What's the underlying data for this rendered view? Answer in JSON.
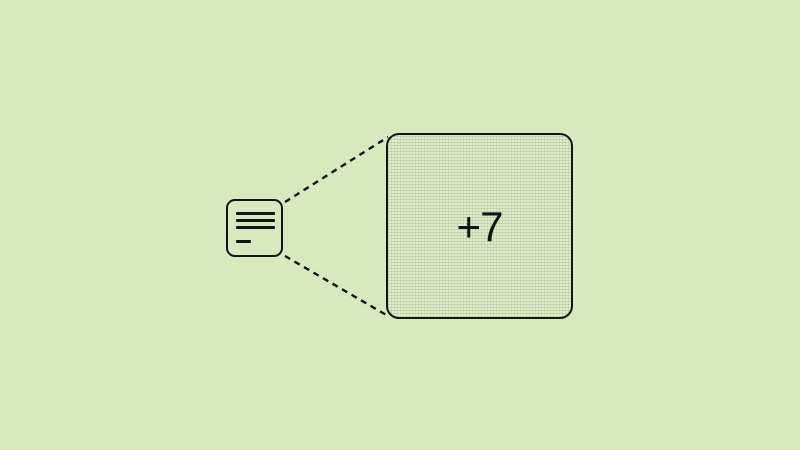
{
  "scene": {
    "background_color": "#d8eabd",
    "stroke_color": "#141414",
    "note_icon": {
      "name": "note-icon",
      "description": "small rounded document card with three text lines and one short line"
    },
    "connectors": {
      "style": "dashed",
      "count": 2
    },
    "expanded": {
      "label": "+7",
      "fill_color": "#dfeccb",
      "texture": "fine-dot-grid"
    }
  }
}
